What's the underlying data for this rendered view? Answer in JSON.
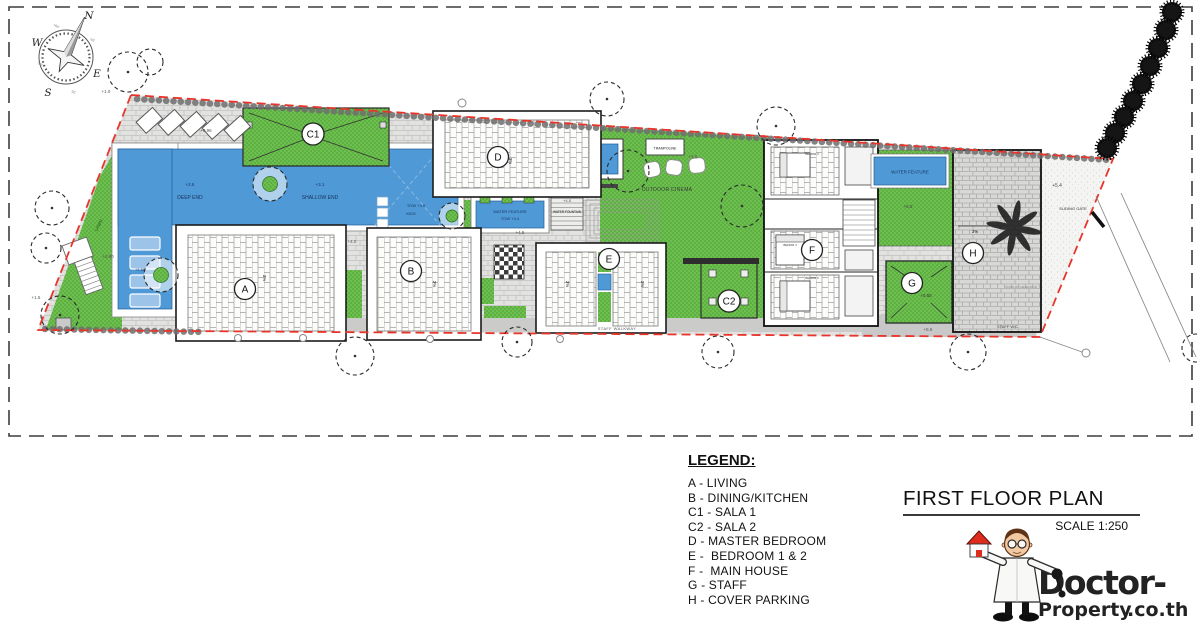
{
  "colors": {
    "grass_green": "#6cc14e",
    "pool_blue": "#4f99d6",
    "boundary_red": "#e8352b",
    "logo_red": "#d42a20"
  },
  "compass": {
    "n": "N",
    "e": "E",
    "s": "S",
    "w": "W",
    "nw": "NW",
    "ne": "NE",
    "sw": "SW",
    "se": "SE"
  },
  "rooms": {
    "a": "A",
    "b": "B",
    "c1": "C1",
    "c2": "C2",
    "d": "D",
    "e": "E",
    "f": "F",
    "g": "G",
    "h": "H"
  },
  "labels": {
    "deep_end": "DEEP END",
    "shallow_end": "SHALLOW END",
    "lawn": "LAWN",
    "kids_tow": "TOW +3.9",
    "kids": "KIDS",
    "wf_center1": "WATER FEATURE",
    "wf_center2": "TOW +4.4",
    "water_fountain": "WATER FOUNTAIN",
    "trampoline": "TRAMPOLINE",
    "outdoor_cinema": "OUTDOOR CINEMA",
    "staff_walkway": "STAFF WALKWAY",
    "wf_right": "WATER FEATURE",
    "sliding_gate": "SLIDING GATE",
    "staff_wc": "STAFF W.C.",
    "standby_generator": "STAND BY GENERATOR",
    "bedrm3": "BEDRM 3",
    "bedrm4": "BEDRM 4",
    "bedrm5": "BEDRM 5",
    "slope": "3%"
  },
  "levels": {
    "l10": "+1.0",
    "l096": "+0.96",
    "l25": "+2.5",
    "l31": "+3.1",
    "l290": "+2.90",
    "l15": "+1.5",
    "l358": "+3.58",
    "l40": "+4.0",
    "l45": "+4.5",
    "l50": "+5.0",
    "l54": "+5.4",
    "l55": "+5.5",
    "l050": "+0.50"
  },
  "legend": {
    "title": "LEGEND:",
    "items": [
      "A - LIVING",
      "B - DINING/KITCHEN",
      "C1 - SALA 1",
      "C2 - SALA 2",
      "D - MASTER BEDROOM",
      "E -  BEDROOM 1 & 2",
      "F -  MAIN HOUSE",
      "G - STAFF",
      "H - COVER PARKING"
    ]
  },
  "title_block": {
    "title": "FIRST FLOOR PLAN",
    "scale": "SCALE 1:250"
  },
  "logo": {
    "word1": "Doctor-",
    "word2": "Property",
    "word3": ".co.th"
  }
}
